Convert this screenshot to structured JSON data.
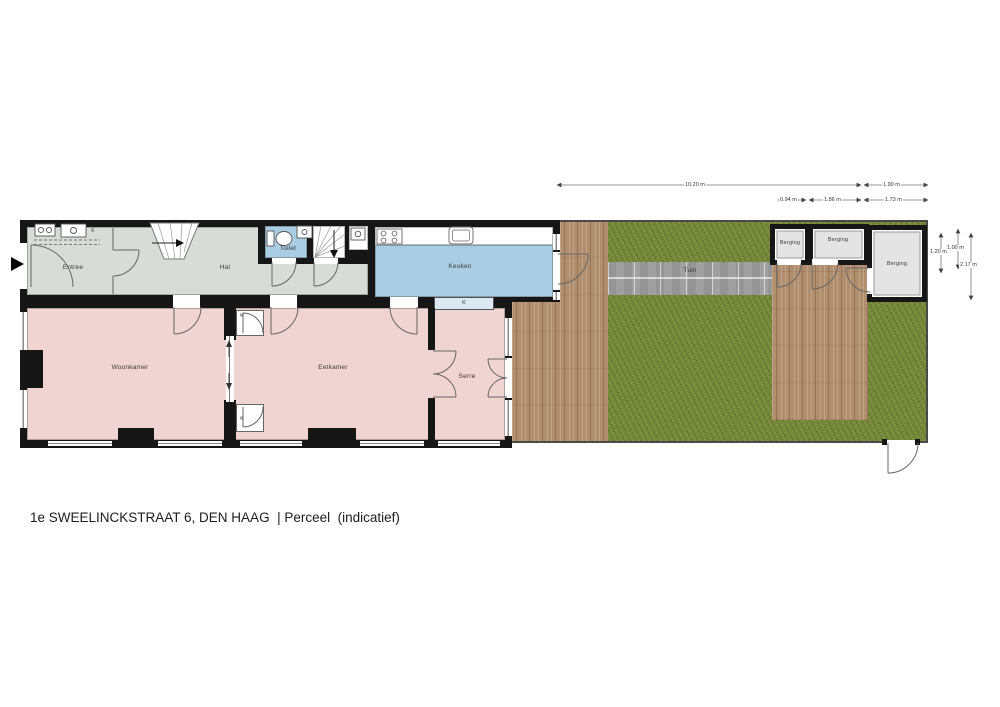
{
  "title": "1e SWEELINCKSTRAAT 6, DEN HAAG  | Perceel  (indicatief)",
  "rooms": {
    "entree": "Entree",
    "hal": "Hal",
    "toilet": "Toilet",
    "keuken": "Keuken",
    "woonkamer": "Woonkamer",
    "eetkamer": "Eetkamer",
    "serre": "Serre",
    "tuin": "Tuin",
    "berging_left": "Berging",
    "berging_middle": "Berging",
    "berging_right": "Berging"
  },
  "closet_label": "K",
  "dimensions": {
    "garden_width": "10.20 m",
    "right_width": "1.90 m",
    "sub_width_1": "0.94 m",
    "sub_width_2": "1.86 m",
    "sub_width_3": "1.73 m",
    "height_1": "1.20 m",
    "height_2": "1.00 m",
    "height_3": "2.17 m"
  },
  "colors": {
    "wall": "#161616",
    "hall_floor": "#d8dcd8",
    "wet_floor": "#a9cde2",
    "living_floor": "#f0d4d2",
    "storage_floor": "#e4e4e4",
    "grass": "#7b8e3e",
    "deck": "#b18e6d",
    "path": "#a0a0a0"
  }
}
